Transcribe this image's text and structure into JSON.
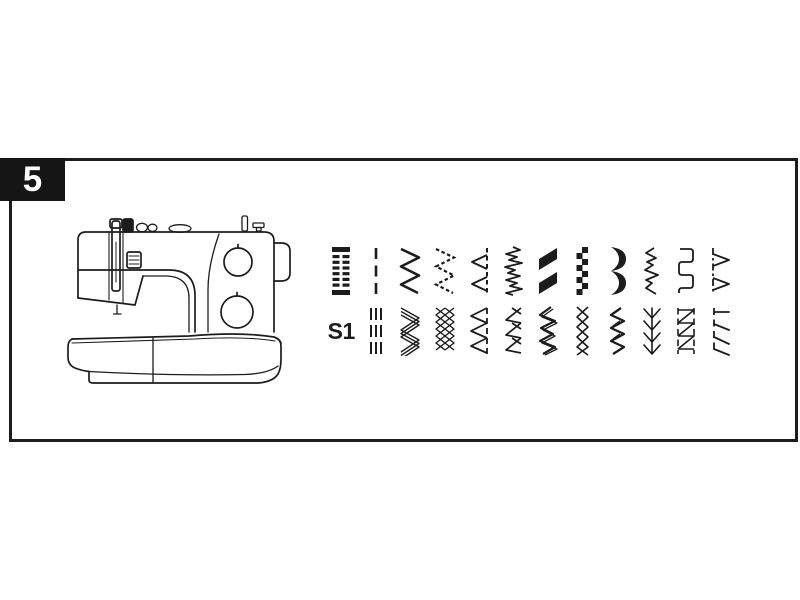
{
  "figure": {
    "step_number": "5"
  },
  "colors": {
    "ink": "#1c1c1c",
    "badge_bg": "#151515",
    "badge_text": "#ffffff",
    "background": "#ffffff"
  },
  "stitch_chart": {
    "rows": [
      {
        "label": "",
        "stitches": [
          "buttonhole",
          "straight",
          "zigzag",
          "three-step-zigzag",
          "blind-hem",
          "elastic",
          "satin-zigzag",
          "stepped-satin",
          "scallop",
          "stretch-zigzag",
          "square-wave",
          "shell-hem"
        ]
      },
      {
        "label": "S1",
        "stitches": [
          "triple-straight",
          "ric-rac",
          "smocking",
          "overcast",
          "feather-zigzag",
          "double-zigzag",
          "cross-stitch",
          "overlock",
          "feather",
          "box-overlock",
          "pin-stitch"
        ]
      }
    ]
  }
}
